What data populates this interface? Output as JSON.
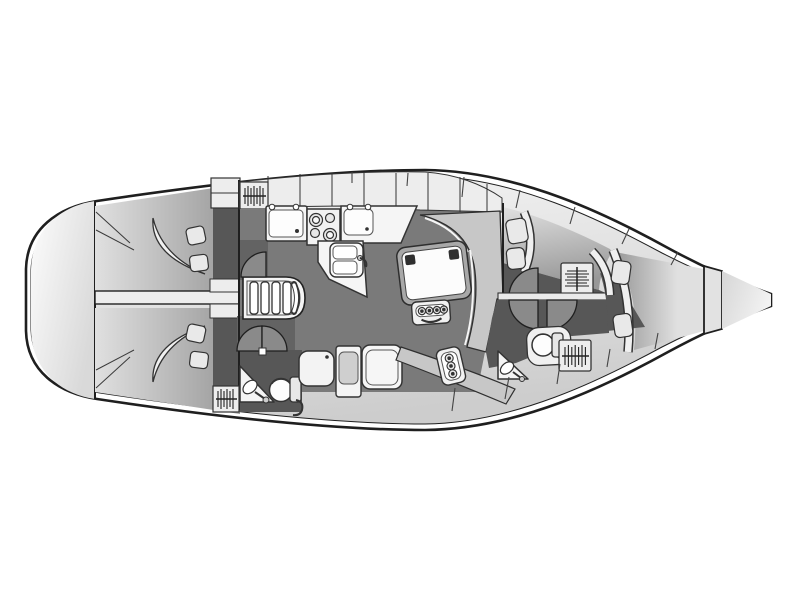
{
  "diagram": {
    "type": "yacht-interior-deck-plan",
    "orientation": {
      "bow": "right",
      "stern": "left",
      "port_side": "top",
      "starboard_side": "bottom"
    },
    "rooms": [
      "lazarette-transom",
      "aft-cabin-port",
      "aft-cabin-starboard",
      "aft-head",
      "companionway",
      "galley",
      "salon",
      "navigation-corner",
      "forward-cabin-port",
      "forward-head",
      "v-berth-cabin",
      "anchor-locker",
      "bow-peak"
    ],
    "fixtures": [
      "double-berth",
      "pillow",
      "headboard",
      "hanging-locker",
      "companionway-stairs",
      "galley-sink",
      "stove-four-burner",
      "double-sink",
      "saloon-table",
      "bottle-rack",
      "settee",
      "navigator-seat",
      "shower-pan",
      "toilet",
      "washbasin",
      "cabin-door"
    ]
  },
  "palette": {
    "page_bg": "#ffffff",
    "outline": "#1f1f1f",
    "hull_white": "#ffffff",
    "deck_a": "#f8f8f8",
    "deck_b": "#cdcdcd",
    "locker_white": "#ededed",
    "floor_salon": "#7a7a7a",
    "floor_dark": "#575757",
    "pocket_dark": "#636363",
    "door_leaf": "#8a8a8a",
    "bed_a": "#e0e0e0",
    "bed_b": "#979797",
    "cushion_gray": "#c7c7c7",
    "furniture_white": "#f5f5f5",
    "table_frame": "#a8a8a8",
    "accent_dark": "#2f2f2f",
    "bow_a": "#f2f2f2",
    "bow_b": "#d6d6d6",
    "pillow_gray": "#e9e9e9"
  }
}
